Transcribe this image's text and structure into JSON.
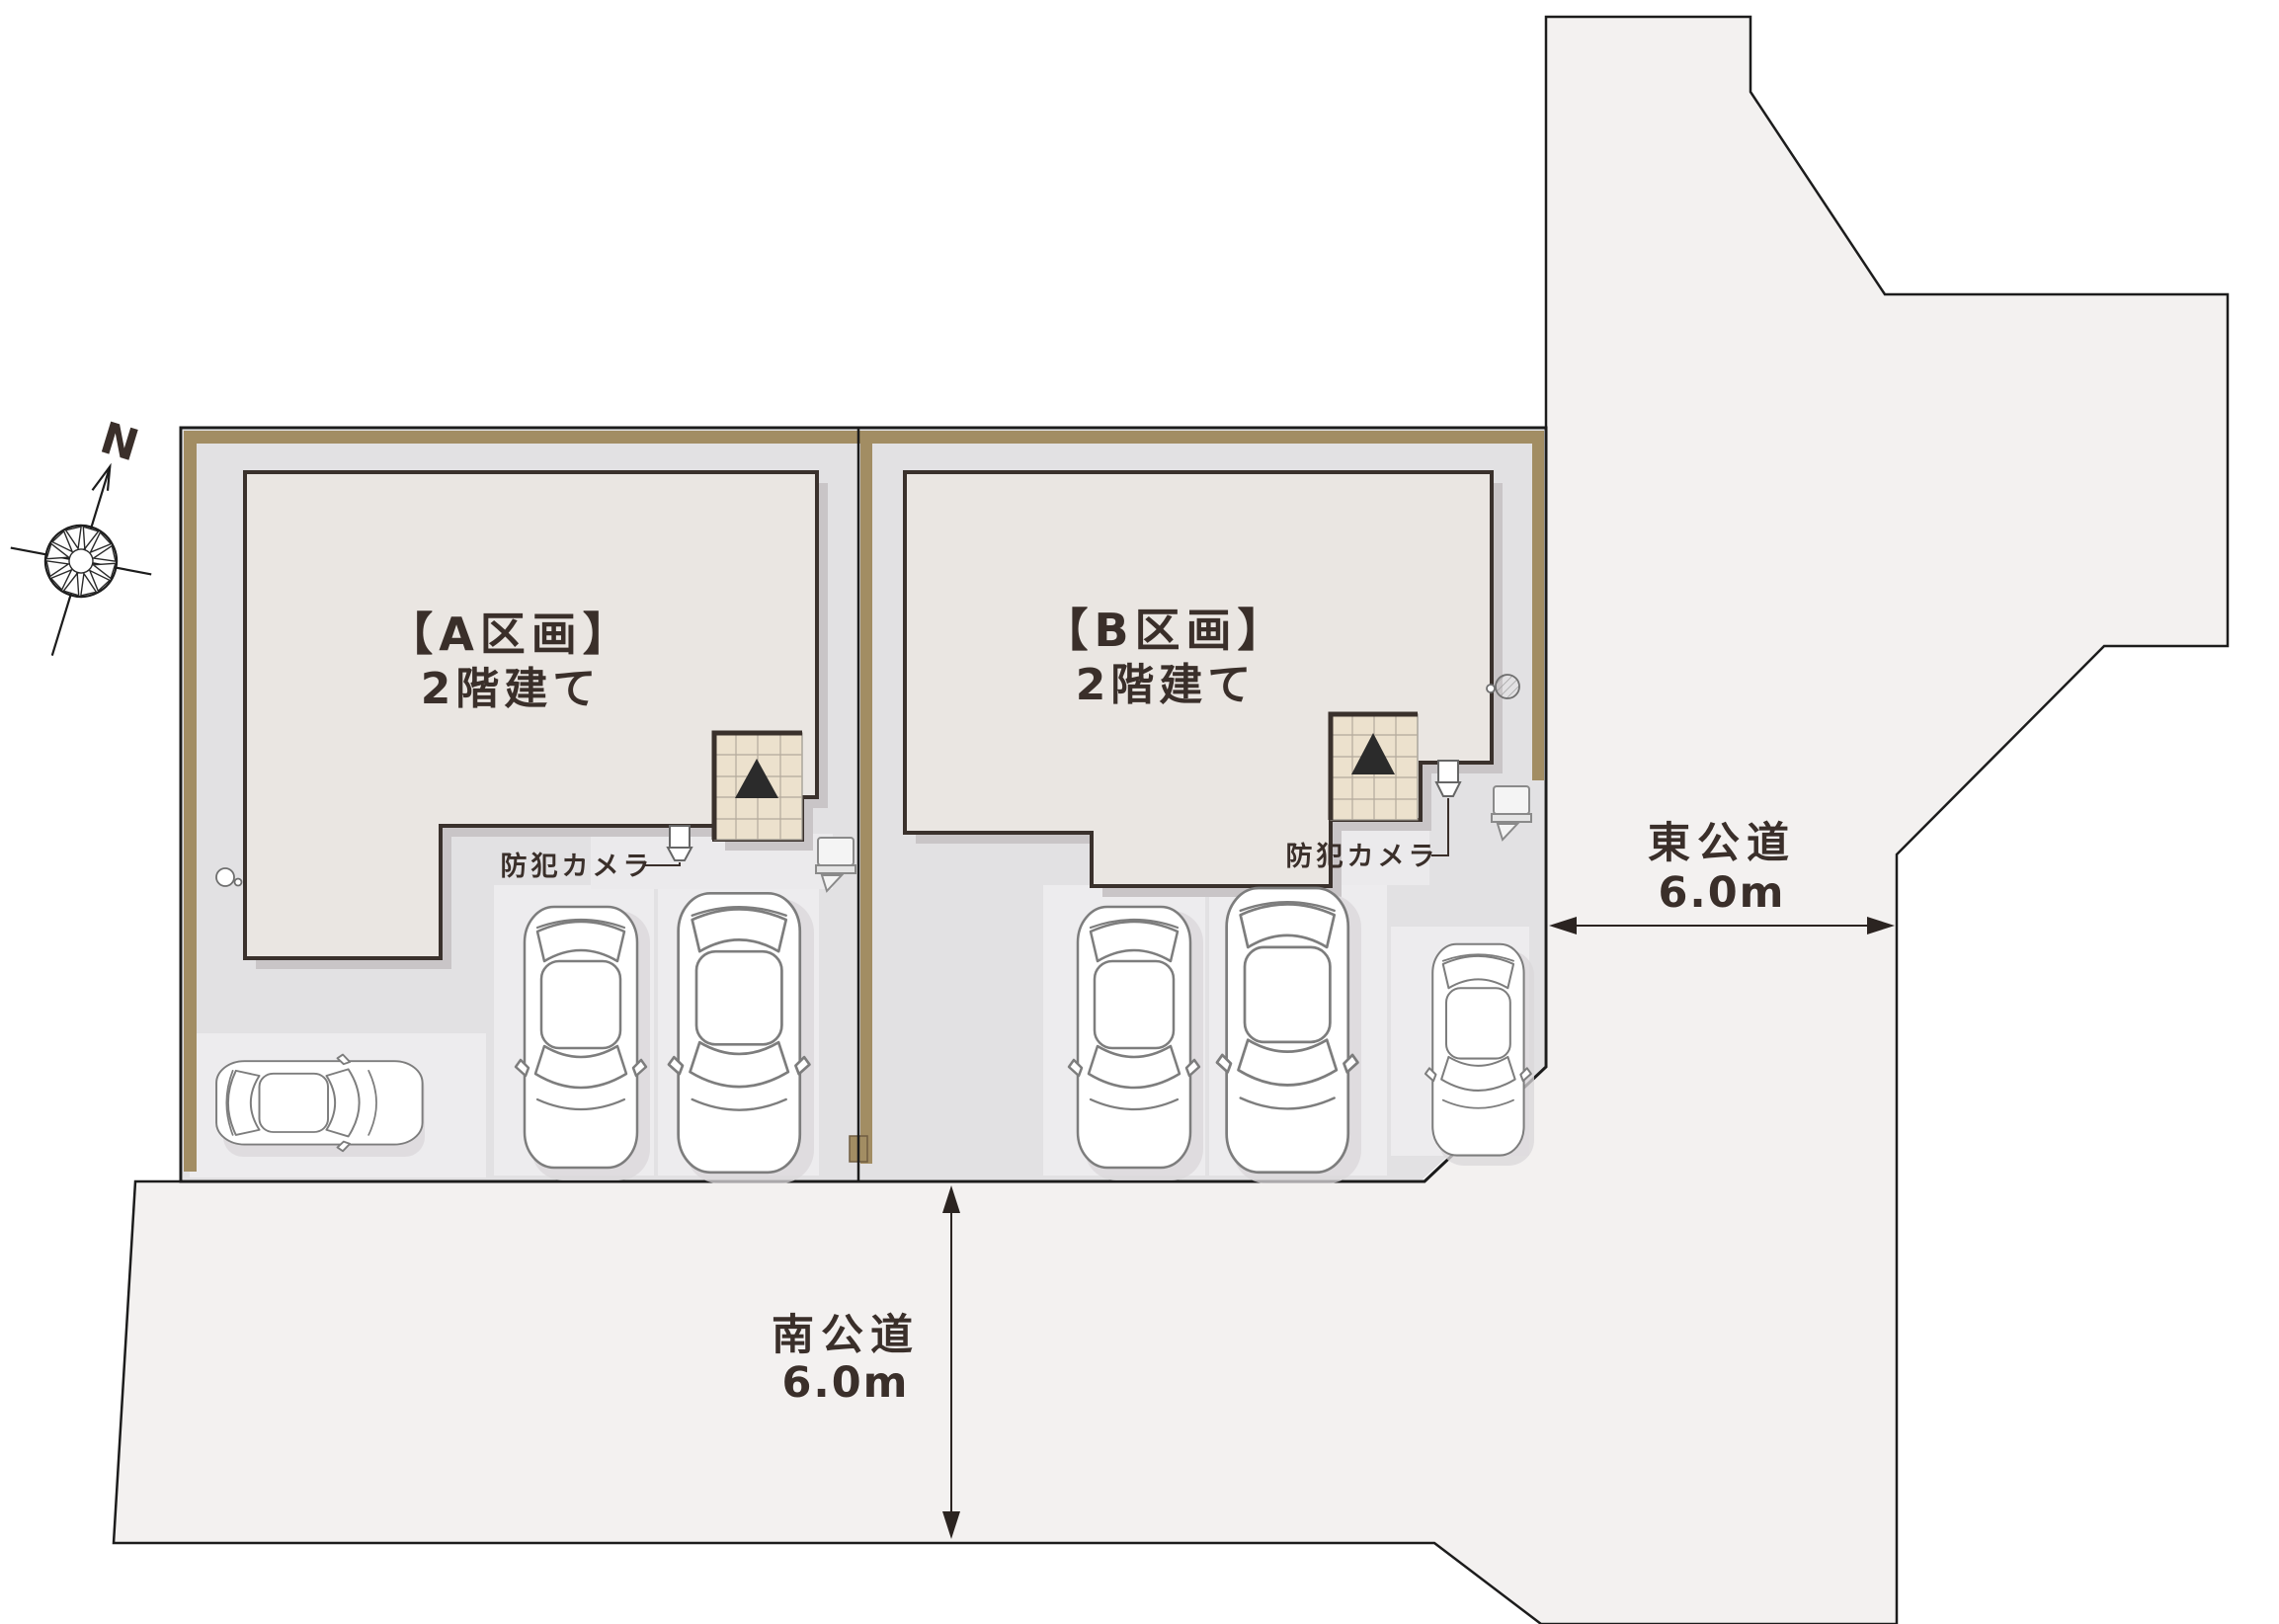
{
  "diagram_type": "real-estate-site-plan",
  "compass": {
    "north_label": "N"
  },
  "plots": [
    {
      "id": "A",
      "name_label": "【A区画】",
      "floors_label": "2階建て",
      "camera_label": "防犯カメラ"
    },
    {
      "id": "B",
      "name_label": "【B区画】",
      "floors_label": "2階建て",
      "camera_label": "防犯カメラ"
    }
  ],
  "roads": {
    "south": {
      "name": "南公道",
      "width_label": "6.0m"
    },
    "east": {
      "name": "東公道",
      "width_label": "6.0m"
    }
  },
  "features": {
    "entrance_marker": "black-triangle",
    "security_cameras": 2,
    "cars_plot_a": 3,
    "cars_plot_b": 3
  },
  "colors": {
    "road_fill": "#f3f1f0",
    "lot_ground": "#e2e1e3",
    "parking_stall": "#edecee",
    "fence_tan": "#a28d63",
    "building_fill": "#eae6e2",
    "wall_stroke": "#3a312c",
    "entrance_tile": "#ece1cd",
    "text_dark": "#3a2f2a",
    "outline": "#1c1c1c"
  }
}
